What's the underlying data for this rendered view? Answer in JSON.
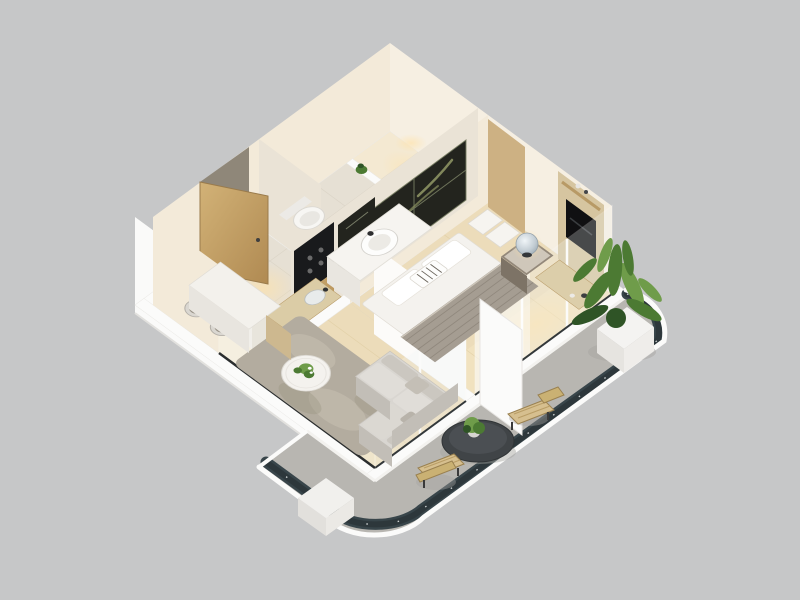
{
  "scene": {
    "type": "3d-isometric-floor-plan-render",
    "description": "Cutaway 3D render of a one-bedroom apartment with curved balcony, viewed from above at an angle on a plain gray backdrop",
    "rooms": [
      {
        "id": "bathroom",
        "items": [
          "shower-area",
          "vanity-counter",
          "sink",
          "toilet",
          "small-plant"
        ]
      },
      {
        "id": "entry-hall",
        "items": [
          "entry-door",
          "hall-artwork",
          "kitchen-counter",
          "cooktop-panel",
          "kitchen-sink"
        ]
      },
      {
        "id": "bedroom",
        "items": [
          "double-bed",
          "gray-throw-blanket",
          "pillows",
          "headboard-artwork",
          "nightstand",
          "dome-lamp",
          "wardrobe-boxes",
          "tv-panel",
          "tv-console"
        ]
      },
      {
        "id": "living-room",
        "items": [
          "corner-sofa",
          "coffee-table",
          "flower-plant",
          "area-rug",
          "dining-table",
          "two-stools",
          "window-walls",
          "sheer-curtains"
        ]
      },
      {
        "id": "balcony",
        "items": [
          "curved-glass-railing",
          "bistro-table",
          "table-plant",
          "rattan-chair-upper",
          "rattan-chair-lower",
          "tall-potted-plant",
          "white-planter",
          "ac-unit-box",
          "white-partition"
        ]
      }
    ]
  },
  "colors": {
    "background": "#c6c7c8",
    "wallTop": "#fbfbfa",
    "wallExterior": "#fafaf9",
    "wallInnerLit": "#f3ead9",
    "wallInnerShade": "#eae3d6",
    "doorRecess": "#8f8779",
    "floorTile": "#e6e0d4",
    "floorTileLit": "#f4e9d2",
    "floorWood": "#ecdcba",
    "floorWoodLit": "#f6e7c2",
    "rug": "#b3ac9f",
    "rugLight": "#c9c2b4",
    "sofa": "#d9d6d1",
    "sofaShade": "#c2beb7",
    "bedWhite": "#f4f2ee",
    "blanket": "#a59d92",
    "blanketDark": "#8d857a",
    "artDark": "#23241e",
    "artMoss": "#99a06a",
    "wood": "#cdb183",
    "woodDark": "#b89a66",
    "counterWood": "#dbcca6",
    "tv": "#101012",
    "glassRail": "#38454a",
    "glassRailDark": "#2b3538",
    "balconyFloor": "#b8b6b1",
    "tableDark": "#404447",
    "rattan": "#d6bf8f",
    "plant": "#4c7a33",
    "plantDark": "#2f5426",
    "plantLight": "#6f9c4a",
    "white": "#ffffff"
  }
}
